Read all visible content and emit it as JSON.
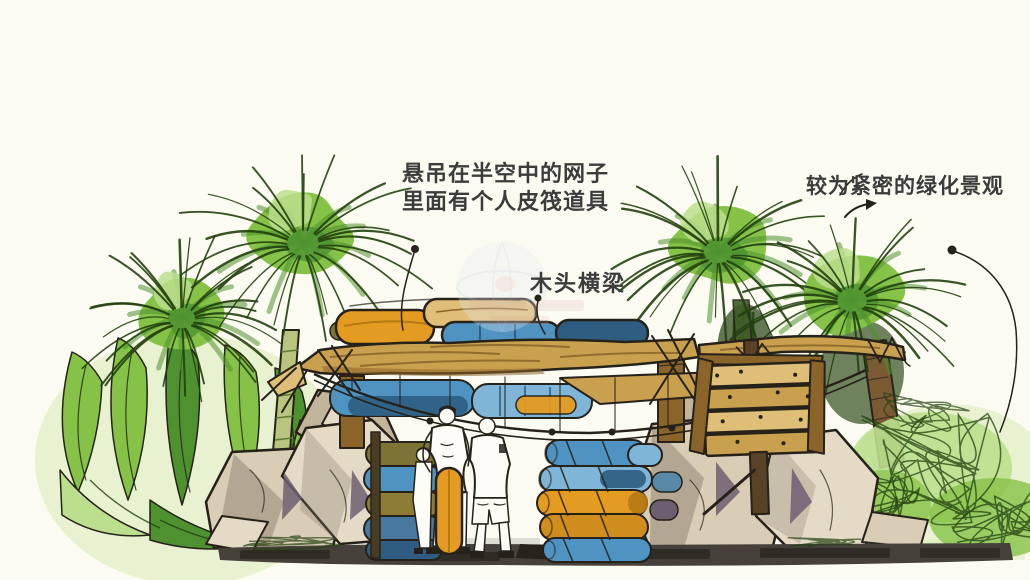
{
  "annotations": {
    "hanging_net": {
      "line1": "悬吊在半空中的网子",
      "line2": "里面有个人皮筏道具"
    },
    "wood_beam": {
      "label": "木头横梁"
    },
    "landscape": {
      "label": "较为紧密的绿化景观"
    }
  },
  "colors": {
    "paper": "#fcfbf1",
    "ink": "#26221a",
    "annotation": "#3c3c3c",
    "foliage": "#85c247",
    "foliage_dark": "#4e9230",
    "foliage_deep": "#22400f",
    "foliage_light": "#bcdf8e",
    "wash_green": "#dcedbb",
    "bamboo": "#b9c47e",
    "bamboo_dark": "#5f7a33",
    "trunk_brown": "#7a5a33",
    "wood": "#c9a04e",
    "wood_light": "#dfbe78",
    "wood_dark": "#8a6428",
    "wood_deep": "#5a4226",
    "tube_blue": "#4f93c2",
    "tube_blue_dark": "#2e5d81",
    "tube_blue_light": "#7fb5d6",
    "tube_orange": "#e49b22",
    "tube_orange_dark": "#b57a14",
    "olive": "#7c7434",
    "rock": "#d9cdb5",
    "rock_mid": "#c3b59b",
    "rock_light": "#e4dac6",
    "rock_shadow": "#857769",
    "rock_purple": "#6e5e71",
    "ground": "#45413a",
    "ground_dark": "#26231e",
    "ground_light": "#c9c5bd",
    "white": "#fdfcf6",
    "watermark_blue": "#e6ebf1",
    "watermark_red": "#d9a9a2"
  }
}
